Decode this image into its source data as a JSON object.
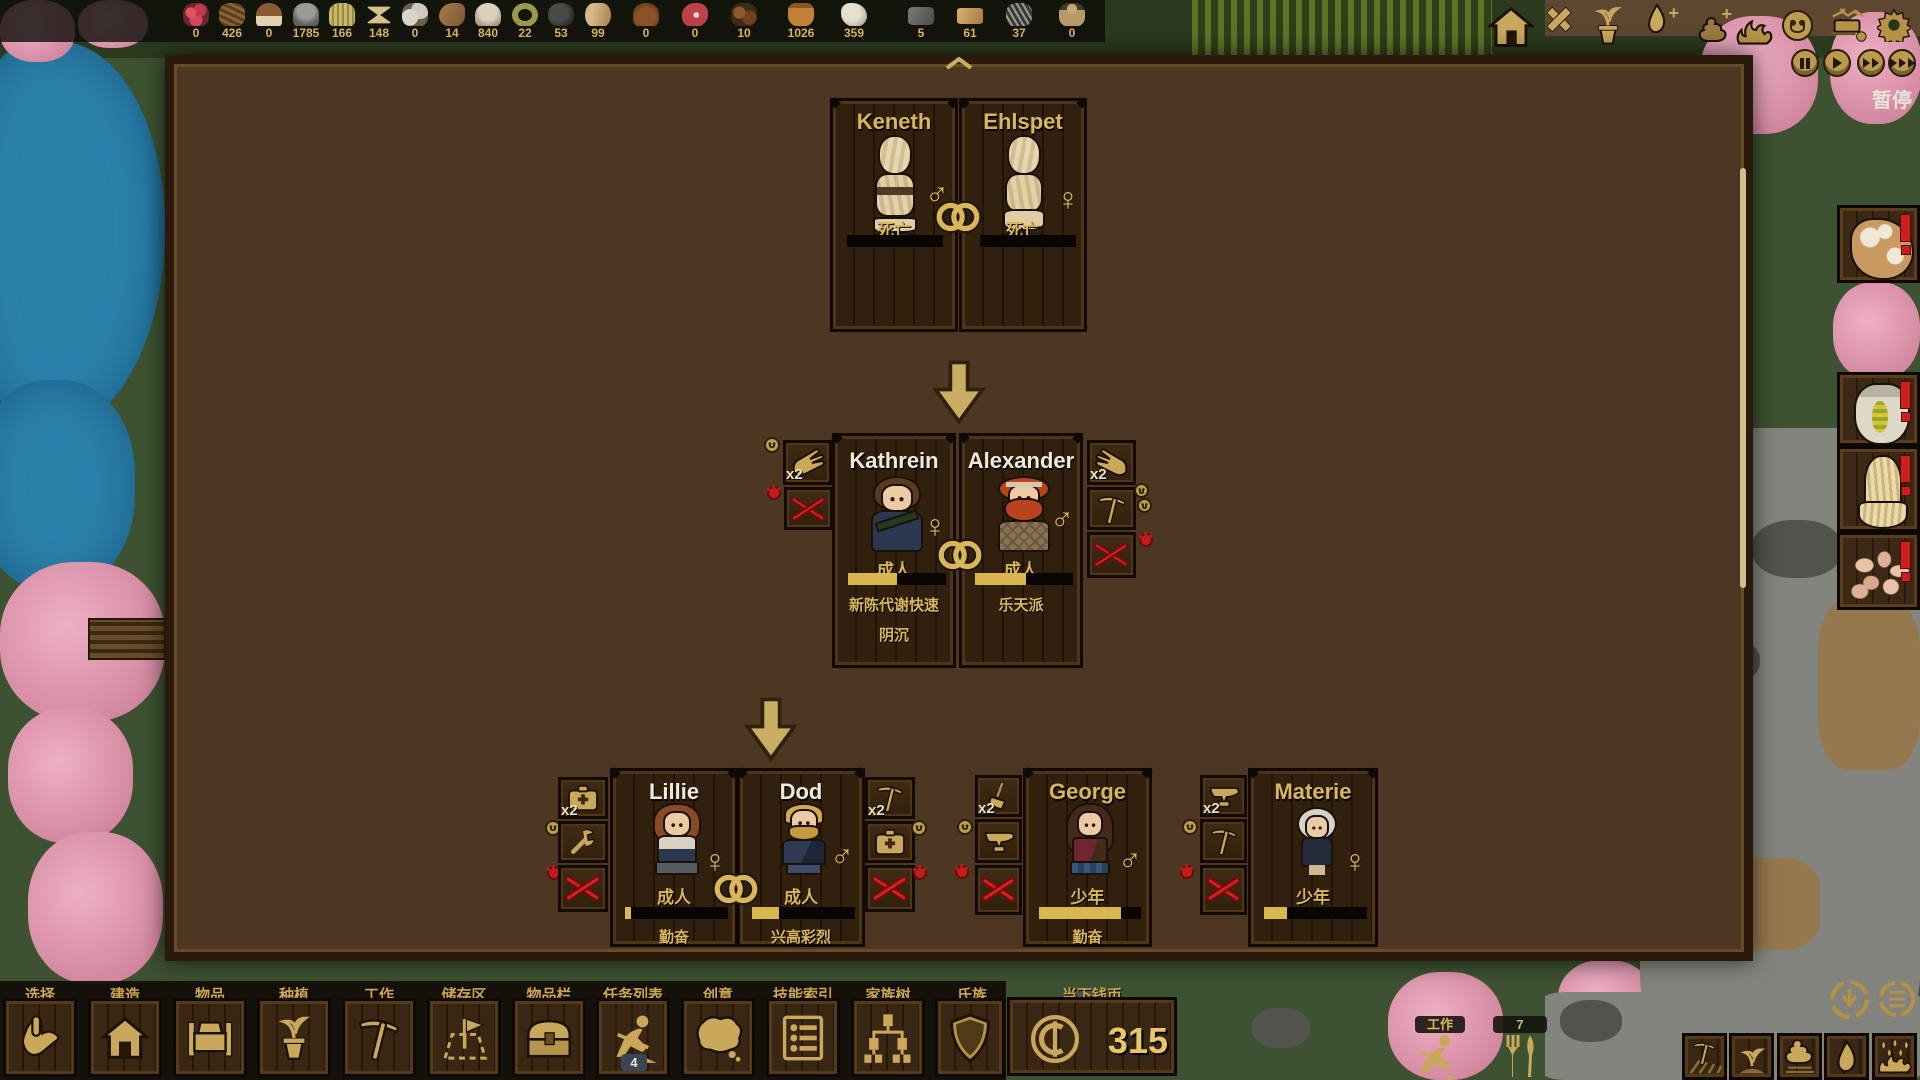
{
  "resource_bar": {
    "items": [
      {
        "name": "berries",
        "value": "0"
      },
      {
        "name": "sticks",
        "value": "426"
      },
      {
        "name": "mushroom",
        "value": "0"
      },
      {
        "name": "ore",
        "value": "1785"
      },
      {
        "name": "hay",
        "value": "166"
      },
      {
        "name": "ration",
        "value": "148"
      },
      {
        "name": "bone",
        "value": "0"
      },
      {
        "name": "slug",
        "value": "14"
      },
      {
        "name": "stone",
        "value": "840"
      },
      {
        "name": "rope",
        "value": "22"
      },
      {
        "name": "coal",
        "value": "53"
      },
      {
        "name": "log",
        "value": "99"
      },
      {
        "name": "dirt",
        "value": "0"
      },
      {
        "name": "meat",
        "value": "0"
      },
      {
        "name": "acorn",
        "value": "10"
      },
      {
        "name": "jug",
        "value": "1026"
      },
      {
        "name": "hide",
        "value": "359"
      },
      {
        "name": "ingot",
        "value": "5"
      },
      {
        "name": "plank",
        "value": "61"
      },
      {
        "name": "nails",
        "value": "37"
      },
      {
        "name": "doll",
        "value": "0"
      }
    ]
  },
  "top_right": {
    "pause_label": "暂停"
  },
  "family_tree": {
    "x2_label": "x2",
    "cards": [
      {
        "name": "Keneth",
        "gender": "♂",
        "status": "死亡",
        "trait1": "",
        "trait2": "",
        "bar": 0
      },
      {
        "name": "Ehlspet",
        "gender": "♀",
        "status": "死亡",
        "trait1": "",
        "trait2": "",
        "bar": 0
      },
      {
        "name": "Kathrein",
        "gender": "♀",
        "status": "成人",
        "trait1": "新陈代谢快速",
        "trait2": "阴沉",
        "bar": 50
      },
      {
        "name": "Alexander",
        "gender": "♂",
        "status": "成人",
        "trait1": "乐天派",
        "trait2": "",
        "bar": 52
      },
      {
        "name": "Lillie",
        "gender": "♀",
        "status": "成人",
        "trait1": "勤奋",
        "trait2": "",
        "bar": 6
      },
      {
        "name": "Dod",
        "gender": "♂",
        "status": "成人",
        "trait1": "兴高彩烈",
        "trait2": "",
        "bar": 26
      },
      {
        "name": "George",
        "gender": "♂",
        "status": "少年",
        "trait1": "勤奋",
        "trait2": "",
        "bar": 80
      },
      {
        "name": "Materie",
        "gender": "♀",
        "status": "少年",
        "trait1": "",
        "trait2": "",
        "bar": 22
      }
    ]
  },
  "toolbar": {
    "tabs": [
      "选择",
      "建造",
      "物品",
      "种植",
      "工作",
      "储存区",
      "物品栏",
      "任务列表",
      "创意",
      "技能索引",
      "家族树",
      "氏族"
    ],
    "task_badge": "4",
    "currency_label": "当下钱币",
    "currency_value": "315"
  },
  "world_markers": {
    "work_label": "工作",
    "food_count": "7"
  }
}
